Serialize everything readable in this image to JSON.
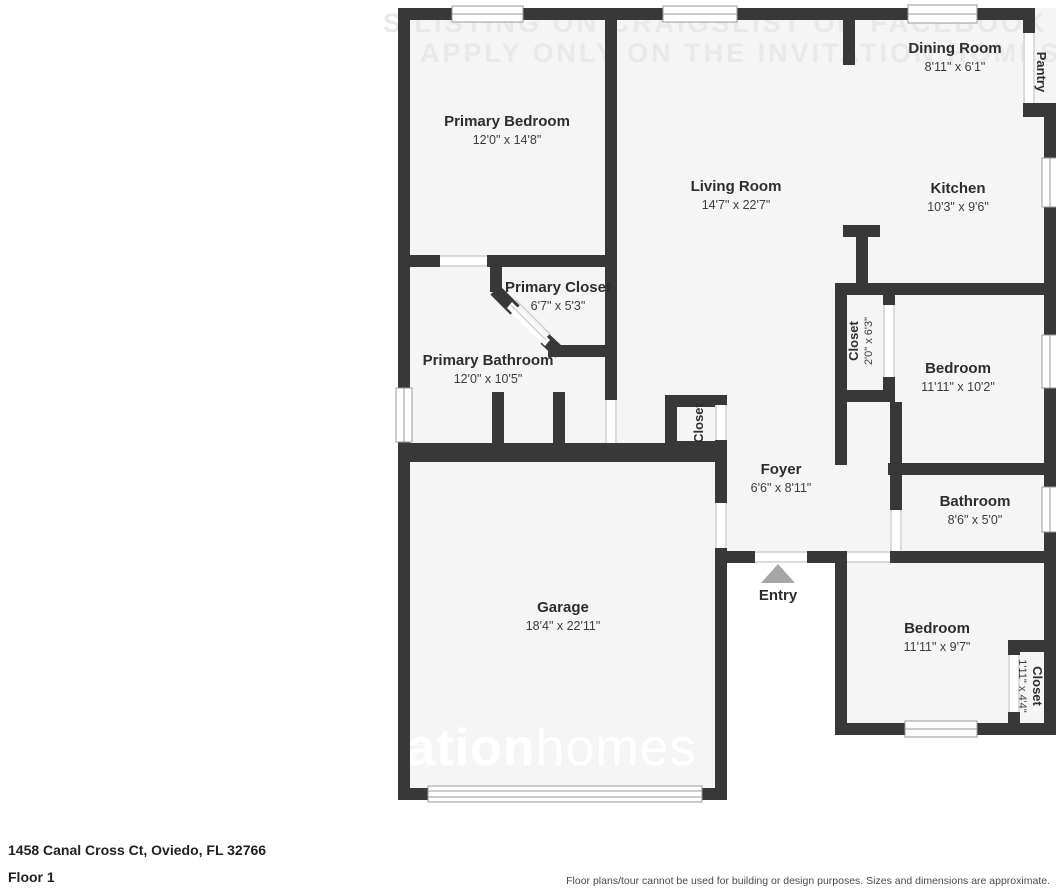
{
  "meta": {
    "address": "1458 Canal Cross Ct, Oviedo, FL 32766",
    "floor_label": "Floor 1",
    "disclaimer": "Floor plans/tour cannot be used for building or design purposes. Sizes and dimensions are approximate."
  },
  "watermarks": {
    "top_line1": "S LISTING ON CRAIGSLIST OR FACEBOOK MARKETPLACE",
    "top_line2": "APPLY ONLY ON THE INVITATION HOMES WEBSITE",
    "bottom_left": "tation",
    "bottom_right": "homes"
  },
  "colors": {
    "wall": "#383838",
    "room_fill": "#f5f5f5",
    "entry_arrow": "#a6a6a6",
    "watermark": "#e9e9e9"
  },
  "rooms": {
    "dining_room": {
      "name": "Dining Room",
      "dims": "8'11\" x 6'1\""
    },
    "pantry": {
      "name": "Pantry"
    },
    "primary_bedroom": {
      "name": "Primary Bedroom",
      "dims": "12'0\" x 14'8\""
    },
    "living_room": {
      "name": "Living Room",
      "dims": "14'7\" x 22'7\""
    },
    "kitchen": {
      "name": "Kitchen",
      "dims": "10'3\" x 9'6\""
    },
    "primary_closet": {
      "name": "Primary Closet",
      "dims": "6'7\" x 5'3\""
    },
    "primary_bathroom": {
      "name": "Primary Bathroom",
      "dims": "12'0\" x 10'5\""
    },
    "hall_closet": {
      "name": "Closet",
      "dims": "2'0\" x 6'3\""
    },
    "bedroom_2": {
      "name": "Bedroom",
      "dims": "11'11\" x 10'2\""
    },
    "foyer_closet": {
      "name": "Closet"
    },
    "foyer": {
      "name": "Foyer",
      "dims": "6'6\" x 8'11\""
    },
    "bathroom": {
      "name": "Bathroom",
      "dims": "8'6\" x 5'0\""
    },
    "entry": {
      "name": "Entry"
    },
    "garage": {
      "name": "Garage",
      "dims": "18'4\" x 22'11\""
    },
    "bedroom_3": {
      "name": "Bedroom",
      "dims": "11'11\" x 9'7\""
    },
    "bedroom_3_closet": {
      "name": "Closet",
      "dims": "1'11\" x 4'4\""
    }
  }
}
